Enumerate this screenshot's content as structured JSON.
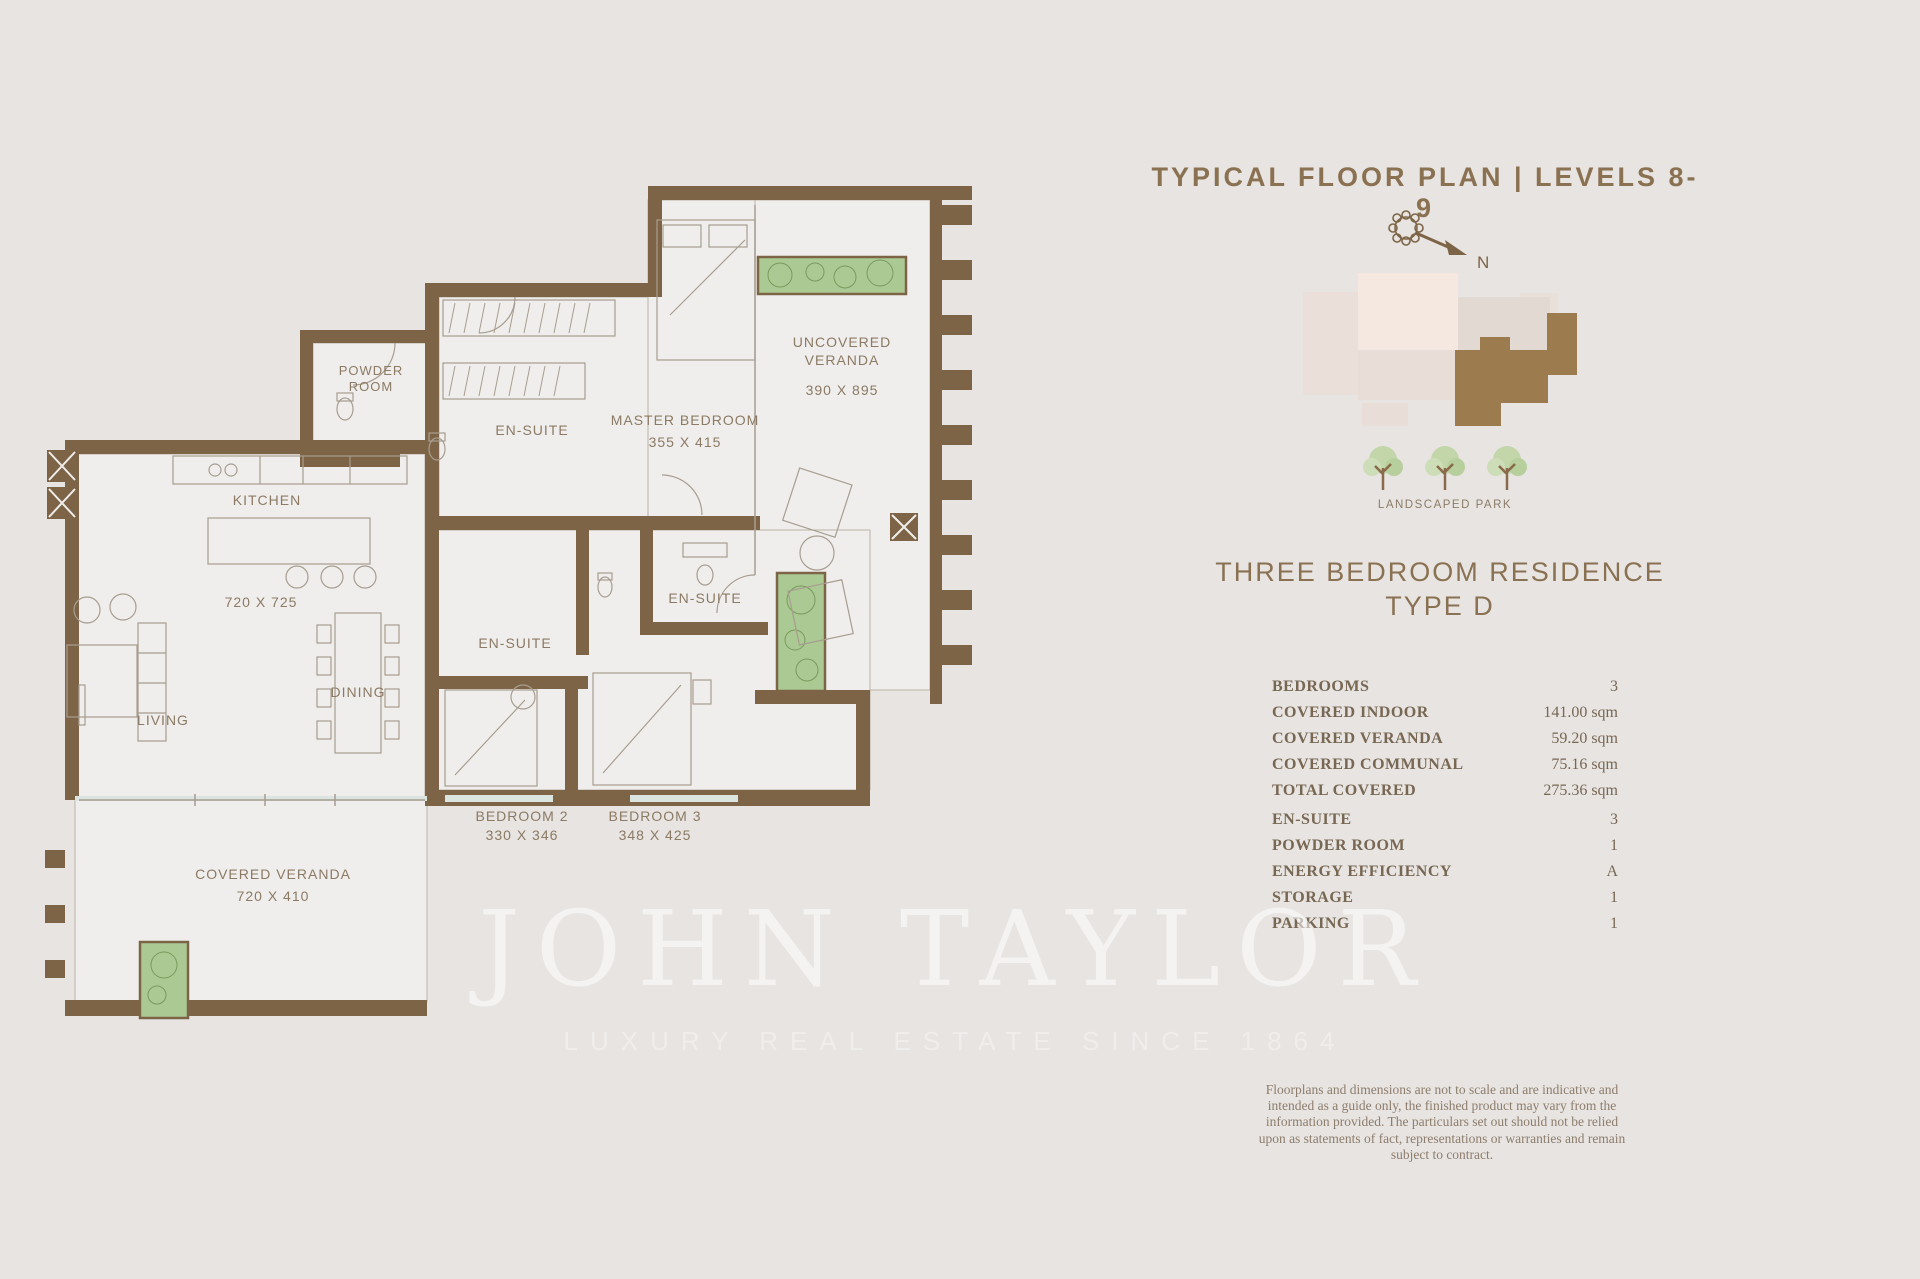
{
  "header": {
    "title": "TYPICAL FLOOR PLAN | LEVELS 8-9"
  },
  "compass": {
    "north_label": "N"
  },
  "site_plan": {
    "caption": "LANDSCAPED PARK"
  },
  "residence": {
    "title_line1": "THREE BEDROOM RESIDENCE",
    "title_line2": "TYPE D"
  },
  "specs": {
    "rows": [
      {
        "label": "BEDROOMS",
        "value": "3"
      },
      {
        "label": "COVERED INDOOR",
        "value": "141.00 sqm"
      },
      {
        "label": "COVERED VERANDA",
        "value": "59.20 sqm"
      },
      {
        "label": "COVERED COMMUNAL",
        "value": "75.16 sqm"
      },
      {
        "label": "TOTAL COVERED",
        "value": "275.36 sqm"
      },
      {
        "label": "EN-SUITE",
        "value": "3"
      },
      {
        "label": "POWDER ROOM",
        "value": "1"
      },
      {
        "label": "ENERGY EFFICIENCY",
        "value": "A"
      },
      {
        "label": "STORAGE",
        "value": "1"
      },
      {
        "label": "PARKING",
        "value": "1"
      }
    ]
  },
  "disclaimer": "Floorplans and dimensions are not to scale and are indicative and intended as a guide only, the finished product may vary from the information provided. The particulars set out should not be relied upon as statements of fact, representations or warranties and remain subject to contract.",
  "watermark": {
    "brand": "JOHN TAYLOR",
    "tagline": "LUXURY REAL ESTATE SINCE 1864"
  },
  "floor_plan": {
    "labels": {
      "kitchen": "KITCHEN",
      "kitchen_dim": "720 X 725",
      "living": "LIVING",
      "dining": "DINING",
      "powder_room": [
        "POWDER",
        "ROOM"
      ],
      "master_bedroom": "MASTER BEDROOM",
      "master_bedroom_dim": "355 X 415",
      "ensuite_master": "EN-SUITE",
      "ensuite_bedroom2": "EN-SUITE",
      "ensuite_bedroom3": "EN-SUITE",
      "uncovered_veranda": [
        "UNCOVERED",
        "VERANDA"
      ],
      "uncovered_veranda_dim": "390 X 895",
      "bedroom2": "BEDROOM 2",
      "bedroom2_dim": "330 X 346",
      "bedroom3": "BEDROOM 3",
      "bedroom3_dim": "348 X 425",
      "covered_veranda": "COVERED VERANDA",
      "covered_veranda_dim": "720 X 410"
    }
  },
  "colors": {
    "background": "#e7e4e1",
    "accent_brown": "#8a7152",
    "wall_brown": "#7d6447",
    "planter_green": "#abc993",
    "unit_highlight": "#9c7b4f",
    "table_text": "#776753"
  }
}
